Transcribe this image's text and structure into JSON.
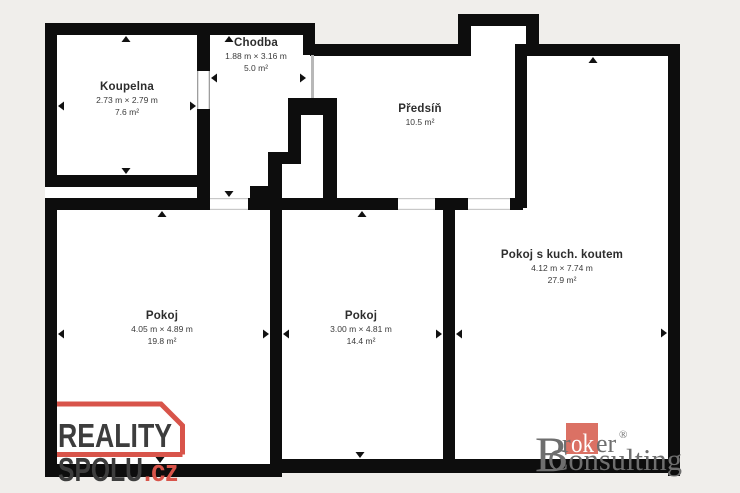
{
  "colors": {
    "background": "#f0eeeb",
    "wall": "#0d0d0d",
    "room_fill": "#ffffff",
    "accent_red": "#d8544a",
    "broker_red": "#db7164",
    "broker_gray": "#6e6e6e"
  },
  "rooms": {
    "koupelna": {
      "name": "Koupelna",
      "dims": "2.73 m × 2.79 m",
      "area": "7.6 m²"
    },
    "chodba": {
      "name": "Chodba",
      "dims": "1.88 m × 3.16 m",
      "area": "5.0 m²"
    },
    "predsin": {
      "name": "Předsíň",
      "area": "10.5 m²"
    },
    "pokoj1": {
      "name": "Pokoj",
      "dims": "4.05 m × 4.89 m",
      "area": "19.8 m²"
    },
    "pokoj2": {
      "name": "Pokoj",
      "dims": "3.00 m × 4.81 m",
      "area": "14.4 m²"
    },
    "pokoj_kk": {
      "name": "Pokoj s kuch. koutem",
      "dims": "4.12 m × 7.74 m",
      "area": "27.9 m²"
    }
  },
  "logos": {
    "reality_spolu": {
      "line1": "REALITY",
      "line2": "SPOLU",
      "tld": ".cz"
    },
    "broker": {
      "b": "B",
      "r": "r",
      "ok": "ok",
      "er": "er",
      "reg": "®",
      "consulting": "Consulting"
    }
  }
}
